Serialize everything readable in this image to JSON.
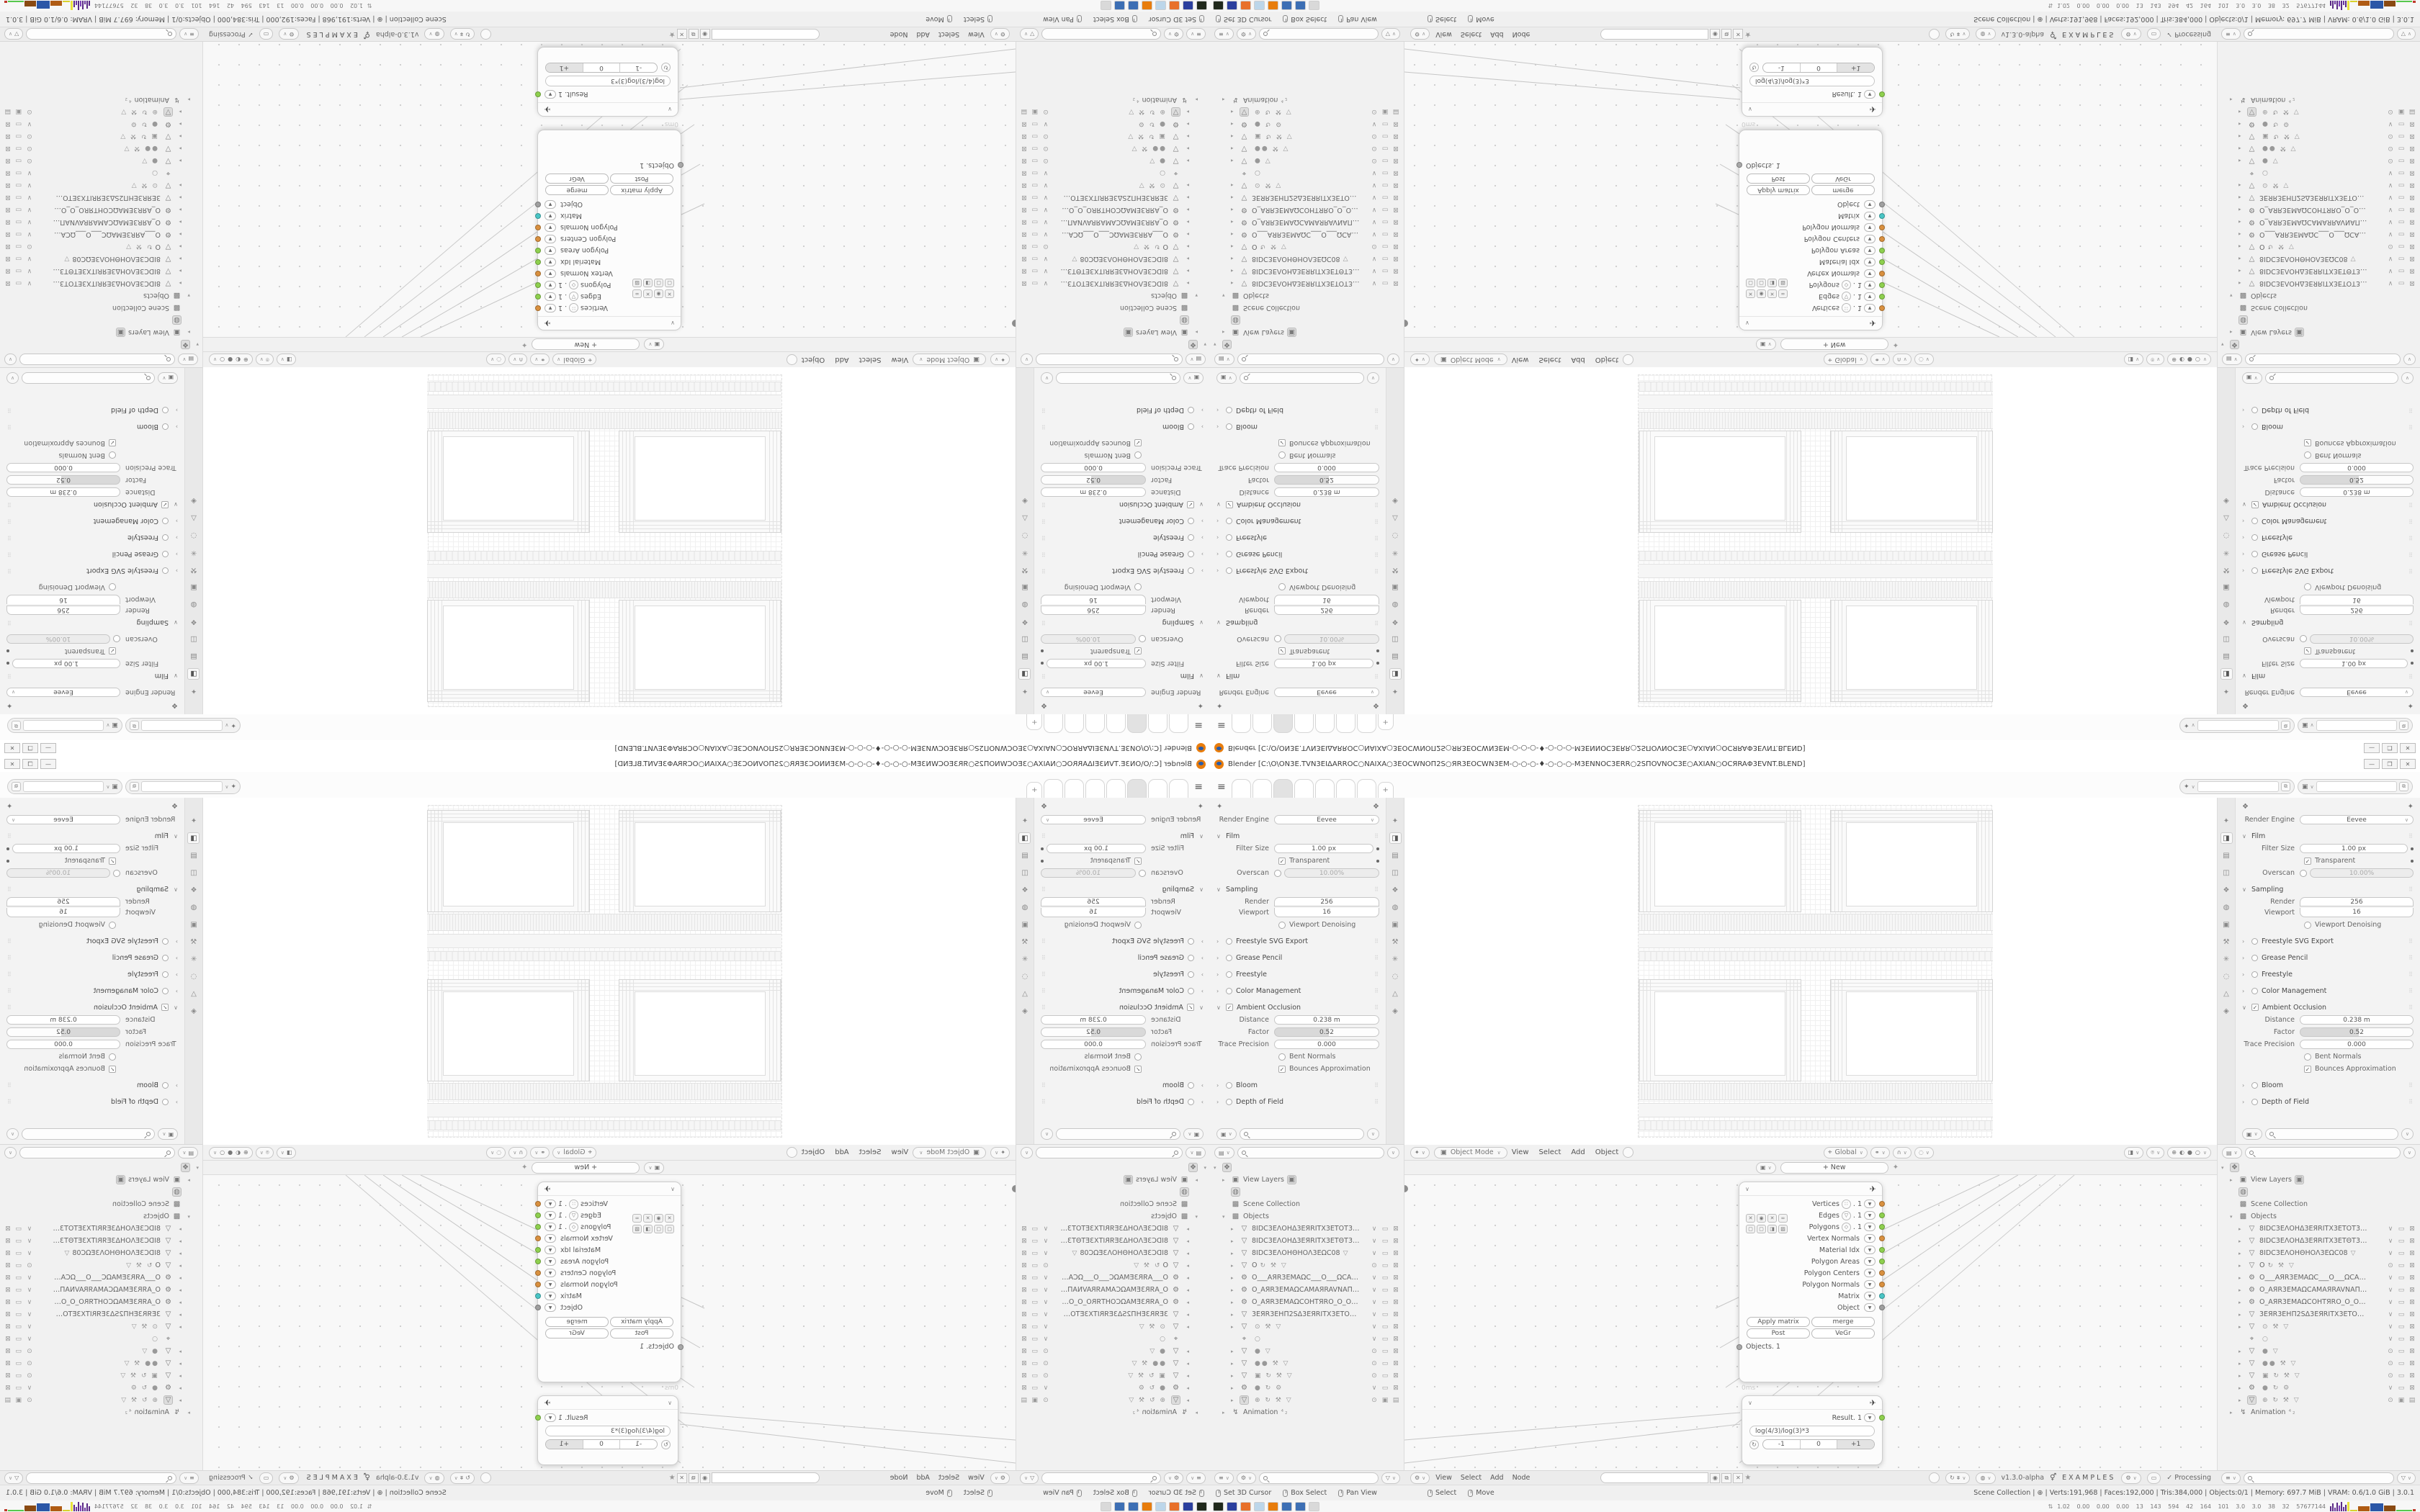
{
  "window": {
    "title": "Blender [C:\\O\\ON3E.TVN3EIΔARRОC○NAIXA○3EОCWNOП2S○ЯR3EОCWN3EM-○-○-○-♦-○-○-○-M3ENNОC3ERR○2SПOVNОC3E○AXIAN○ОCЯRAΦ3EVNT.BLEND]",
    "controls": [
      "—",
      "❐",
      "✕"
    ],
    "hamburger": "≡"
  },
  "topbar": {
    "tabs": [
      {
        "cls": ""
      },
      {
        "cls": ""
      },
      {
        "cls": "active"
      },
      {
        "cls": ""
      },
      {
        "cls": ""
      },
      {
        "cls": ""
      },
      {
        "cls": ""
      }
    ],
    "add_label": "+",
    "widgets": [
      {
        "icon": "✦",
        "chev": "∨"
      },
      {
        "icon": "▣",
        "chev": "∨"
      }
    ]
  },
  "props": {
    "header_icon": "❖",
    "pin_icon": "✦",
    "tabs": [
      {
        "g": "✦"
      },
      {
        "g": "◨",
        "cls": "active"
      },
      {
        "g": "▤"
      },
      {
        "g": "◫"
      },
      {
        "g": "❖"
      },
      {
        "g": "◍"
      },
      {
        "g": "▣"
      },
      {
        "g": "⚒"
      },
      {
        "g": "✳"
      },
      {
        "g": "◌"
      },
      {
        "g": "△"
      },
      {
        "g": "◈"
      }
    ],
    "engine_label": "Render Engine",
    "engine_value": "Eevee",
    "grip": "⠿",
    "film": {
      "title": "Film",
      "filter_label": "Filter Size",
      "filter_value": "1.00 px",
      "transparent_label": "Transparent",
      "overscan_label": "Overscan",
      "overscan_value": "10.00%"
    },
    "sampling": {
      "title": "Sampling",
      "render_label": "Render",
      "render_value": "256",
      "viewport_label": "Viewport",
      "viewport_value": "16",
      "denoise_label": "Viewport Denoising"
    },
    "collapsed1": [
      {
        "t": "Freestyle SVG Export",
        "circle": "y"
      },
      {
        "t": "Grease Pencil"
      },
      {
        "t": "Freestyle",
        "circle": "y"
      },
      {
        "t": "Color Management"
      }
    ],
    "ao": {
      "title": "Ambient Occlusion",
      "distance_label": "Distance",
      "distance_value": "0.238 m",
      "factor_label": "Factor",
      "factor_value": "0.52",
      "trace_label": "Trace Precision",
      "trace_value": "0.000",
      "bent_label": "Bent Normals",
      "bounces_label": "Bounces Approximation"
    },
    "collapsed2": [
      {
        "t": "Bloom",
        "circle": "y"
      },
      {
        "t": "Depth of Field"
      }
    ]
  },
  "outliner": {
    "header": {
      "b1": "▤",
      "b1c": "∨",
      "search": "",
      "b2": "∨"
    },
    "editor_icon": "❖",
    "view_layers": "View Layers",
    "globe_icon": "◍",
    "scene_collection": "Scene Collection",
    "objects_label": "Objects",
    "objects": [
      {
        "a": "▸",
        "i": "▽",
        "n": "8IDC3EΛOHΔ3EЯRITX3ETOT3EXTIS",
        "x": "",
        "r1": "∨",
        "r2": "▭",
        "r3": "⊠"
      },
      {
        "a": "▸",
        "i": "▽",
        "n": "8IDC3EΛOHΔ3EЯRITX3ETΘT3EXTIS",
        "x": "",
        "r1": "∨",
        "r2": "▭",
        "r3": "⊠"
      },
      {
        "a": "▸",
        "i": "▽",
        "n": "8IDC3EΛOHΘHOΛ3EΩC08",
        "x": "▽",
        "r1": "∨",
        "r2": "▭",
        "r3": "⊠"
      },
      {
        "a": "▸",
        "i": "▽",
        "n": "O",
        "x": "↻ ⚒ ▽",
        "r1": "⊙",
        "r2": "▭",
        "r3": "⊠"
      },
      {
        "a": "▸",
        "i": "⚙",
        "n": "O___AЯR3EMAΩC___O___ΩCAM3I",
        "x": "",
        "r1": "∨",
        "r2": "▭",
        "r3": "⊠"
      },
      {
        "a": "▸",
        "i": "⚙",
        "n": "O_AЯR3EMAΩCAMAЯRAVNAΠ__O",
        "x": "",
        "r1": "∨",
        "r2": "▭",
        "r3": "⊠"
      },
      {
        "a": "▸",
        "i": "⚙",
        "n": "O_AЯR3EMAΩCOHTЯRO_O_OЯRTH",
        "x": "",
        "r1": "∨",
        "r2": "▭",
        "r3": "⊠"
      },
      {
        "a": "▸",
        "i": "▽",
        "n": "3EЯR3EHΠ2SΔ3EЯRITX3ETOT3EXTI",
        "x": "",
        "r1": "∨",
        "r2": "▭",
        "r3": "⊠"
      },
      {
        "a": "▸",
        "i": "▽",
        "n": "",
        "x": "⊙ ⚒ ▽",
        "r1": "∨",
        "r2": "▭",
        "r3": "⊠"
      },
      {
        "a": "",
        "i": "⌖",
        "n": "",
        "x": "○",
        "r1": "∨",
        "r2": "▭",
        "r3": "⊠"
      },
      {
        "a": "▸",
        "i": "▽",
        "n": "",
        "x": "● ▽",
        "r1": "⊙",
        "r2": "▭",
        "r3": "⊠"
      },
      {
        "a": "▸",
        "i": "▽",
        "n": "",
        "x": "●● ⚒ ▽",
        "r1": "⊙",
        "r2": "▭",
        "r3": "⊠"
      },
      {
        "a": "▸",
        "i": "▽",
        "n": "",
        "x": "▣ ↻ ⚒ ▽",
        "r1": "⊙",
        "r2": "▭",
        "r3": "⊠"
      },
      {
        "a": "▸",
        "i": "⚙",
        "n": "",
        "x": "● ↻ ⚙",
        "r1": "∨",
        "r2": "▭",
        "r3": "⊠"
      },
      {
        "a": "▸",
        "i": "▽",
        "cls": "boxed",
        "n": "",
        "x": "⊕ ↻ ⚒ ▽",
        "r1": "⊙",
        "r2": "▣",
        "r3": "▤"
      }
    ],
    "animation_label": "Animation",
    "animation_icon": "↯",
    "animation_sub": "⁴₂",
    "footer": {
      "b1": "≡",
      "b2": "⚙",
      "b3": "▽"
    }
  },
  "viewport": {
    "tool_icon": "✦",
    "mode_icon": "▣",
    "mode_label": "Object Mode",
    "menus": [
      "View",
      "Select",
      "Add",
      "Object"
    ],
    "orient_icon": "⌖",
    "orient_label": "Global",
    "snap_group": [
      "⚭",
      "∩",
      "◌"
    ],
    "shading": [
      "⊕",
      "◐",
      "●",
      "○"
    ]
  },
  "node_editor": {
    "hdr_icon": "▣",
    "new_label": "+ New",
    "pin": "✦",
    "big_node": {
      "collapse": "∨",
      "head_icon": "✈",
      "sockets": [
        {
          "label": "Vertices",
          "icon": "∷",
          "suffix": ". 1",
          "color": "#d9903f",
          "noicon": ""
        },
        {
          "label": "Edges",
          "icon": "▽",
          "suffix": ". 1",
          "color": "#8ed04e",
          "noicon": ""
        },
        {
          "label": "Polygons",
          "icon": "◇",
          "suffix": ". 1",
          "color": "#8ed04e",
          "noicon": ""
        },
        {
          "label": "Vertex Normals",
          "icon": "",
          "suffix": "",
          "color": "#d9903f",
          "noicon": "hide"
        },
        {
          "label": "Material Idx",
          "icon": "",
          "suffix": "",
          "color": "#8ed04e",
          "noicon": "hide"
        },
        {
          "label": "Polygon Areas",
          "icon": "",
          "suffix": "",
          "color": "#8ed04e",
          "noicon": "hide"
        },
        {
          "label": "Polygon Centers",
          "icon": "",
          "suffix": "",
          "color": "#d9903f",
          "noicon": "hide"
        },
        {
          "label": "Polygon Normals",
          "icon": "",
          "suffix": "",
          "color": "#d9903f",
          "noicon": "hide"
        },
        {
          "label": "Matrix",
          "icon": "",
          "suffix": "",
          "color": "#49c5c5",
          "noicon": "hide"
        },
        {
          "label": "Object",
          "icon": "",
          "suffix": "",
          "color": "#a0a0a0",
          "noicon": "hide"
        }
      ],
      "mini1": [
        "✕",
        "◉",
        "✕",
        "∞"
      ],
      "mini2": [
        "▢",
        "▢",
        "◨",
        "▨"
      ],
      "buttons": [
        "Apply matrix",
        "merge",
        "Post",
        "VeGr"
      ],
      "objects_label": "Objects. 1"
    },
    "time_label": "0ms",
    "result_node": {
      "collapse": "∨",
      "head_icon": "✈",
      "label": "Result. 1",
      "color": "#8ed04e",
      "expr": "log(4/3)/log(3)*3",
      "buttons": [
        "-1",
        "0",
        "+1"
      ]
    },
    "footer": {
      "tree_icon": "⚙",
      "menus": [
        "View",
        "Select",
        "Add",
        "Node"
      ],
      "shield": "◉",
      "copy": "⧉",
      "close": "✕",
      "pin": "★",
      "version": "v1.3.0-alpha",
      "dna": "⚥",
      "examples": "EXAMPLES",
      "check": "✓",
      "processing": "Processing"
    }
  },
  "status": {
    "left": [
      {
        "label": "Set 3D Cursor"
      },
      {
        "label": "Box Select"
      },
      {
        "label": "Pan View"
      }
    ],
    "center": [
      {
        "label": "Select"
      },
      {
        "label": "Move"
      }
    ],
    "right": "Scene Collection | ⊕ | Verts:191,968 | Faces:192,000 | Tris:384,000 | Objects:0/1 | Memory: 697.7 MiB | VRAM: 0.6/1.0 GiB | 3.0.1"
  },
  "taskbar": {
    "icons": [
      {
        "bg": "#20291c"
      },
      {
        "bg": "#2b3f9e"
      },
      {
        "bg": "#e8702a"
      },
      {
        "bg": "#bcd6ea"
      },
      {
        "bg": "#e87d0d"
      },
      {
        "bg": "#3d6fb4"
      },
      {
        "bg": "#3d6fb4"
      },
      {
        "bg": "#d9d9d9"
      }
    ],
    "monitor": {
      "chev": "⇅",
      "numbers": "1.02 0.00 0.00 0.00 13 143 594 42 164 101 3.0 3.0 38 32 57677144",
      "bars": [
        {
          "w": 2,
          "h": 7,
          "c": "#5a2a86"
        },
        {
          "w": 2,
          "h": 11,
          "c": "#5a2a86"
        },
        {
          "w": 2,
          "h": 5,
          "c": "#6a35a0"
        },
        {
          "w": 2,
          "h": 12,
          "c": "#5a2a86"
        },
        {
          "w": 2,
          "h": 8,
          "c": "#7a3fb5"
        },
        {
          "w": 2,
          "h": 13,
          "c": "#5a2a86"
        },
        {
          "w": 2,
          "h": 6,
          "c": "#6a35a0"
        },
        {
          "w": 2,
          "h": 9,
          "c": "#5a2a86"
        },
        {
          "w": 3,
          "h": 13,
          "c": "#e8e23a"
        },
        {
          "w": 10,
          "h": 2,
          "c": "#d8d22e"
        },
        {
          "w": 16,
          "h": 7,
          "c": "#b05c14"
        },
        {
          "w": 18,
          "h": 11,
          "c": "#2b57a7"
        },
        {
          "w": 16,
          "h": 8,
          "c": "#8a4a12"
        },
        {
          "w": 22,
          "h": 2,
          "c": "#57c84d"
        },
        {
          "w": 4,
          "h": 3,
          "c": "#c0392b"
        }
      ]
    }
  }
}
